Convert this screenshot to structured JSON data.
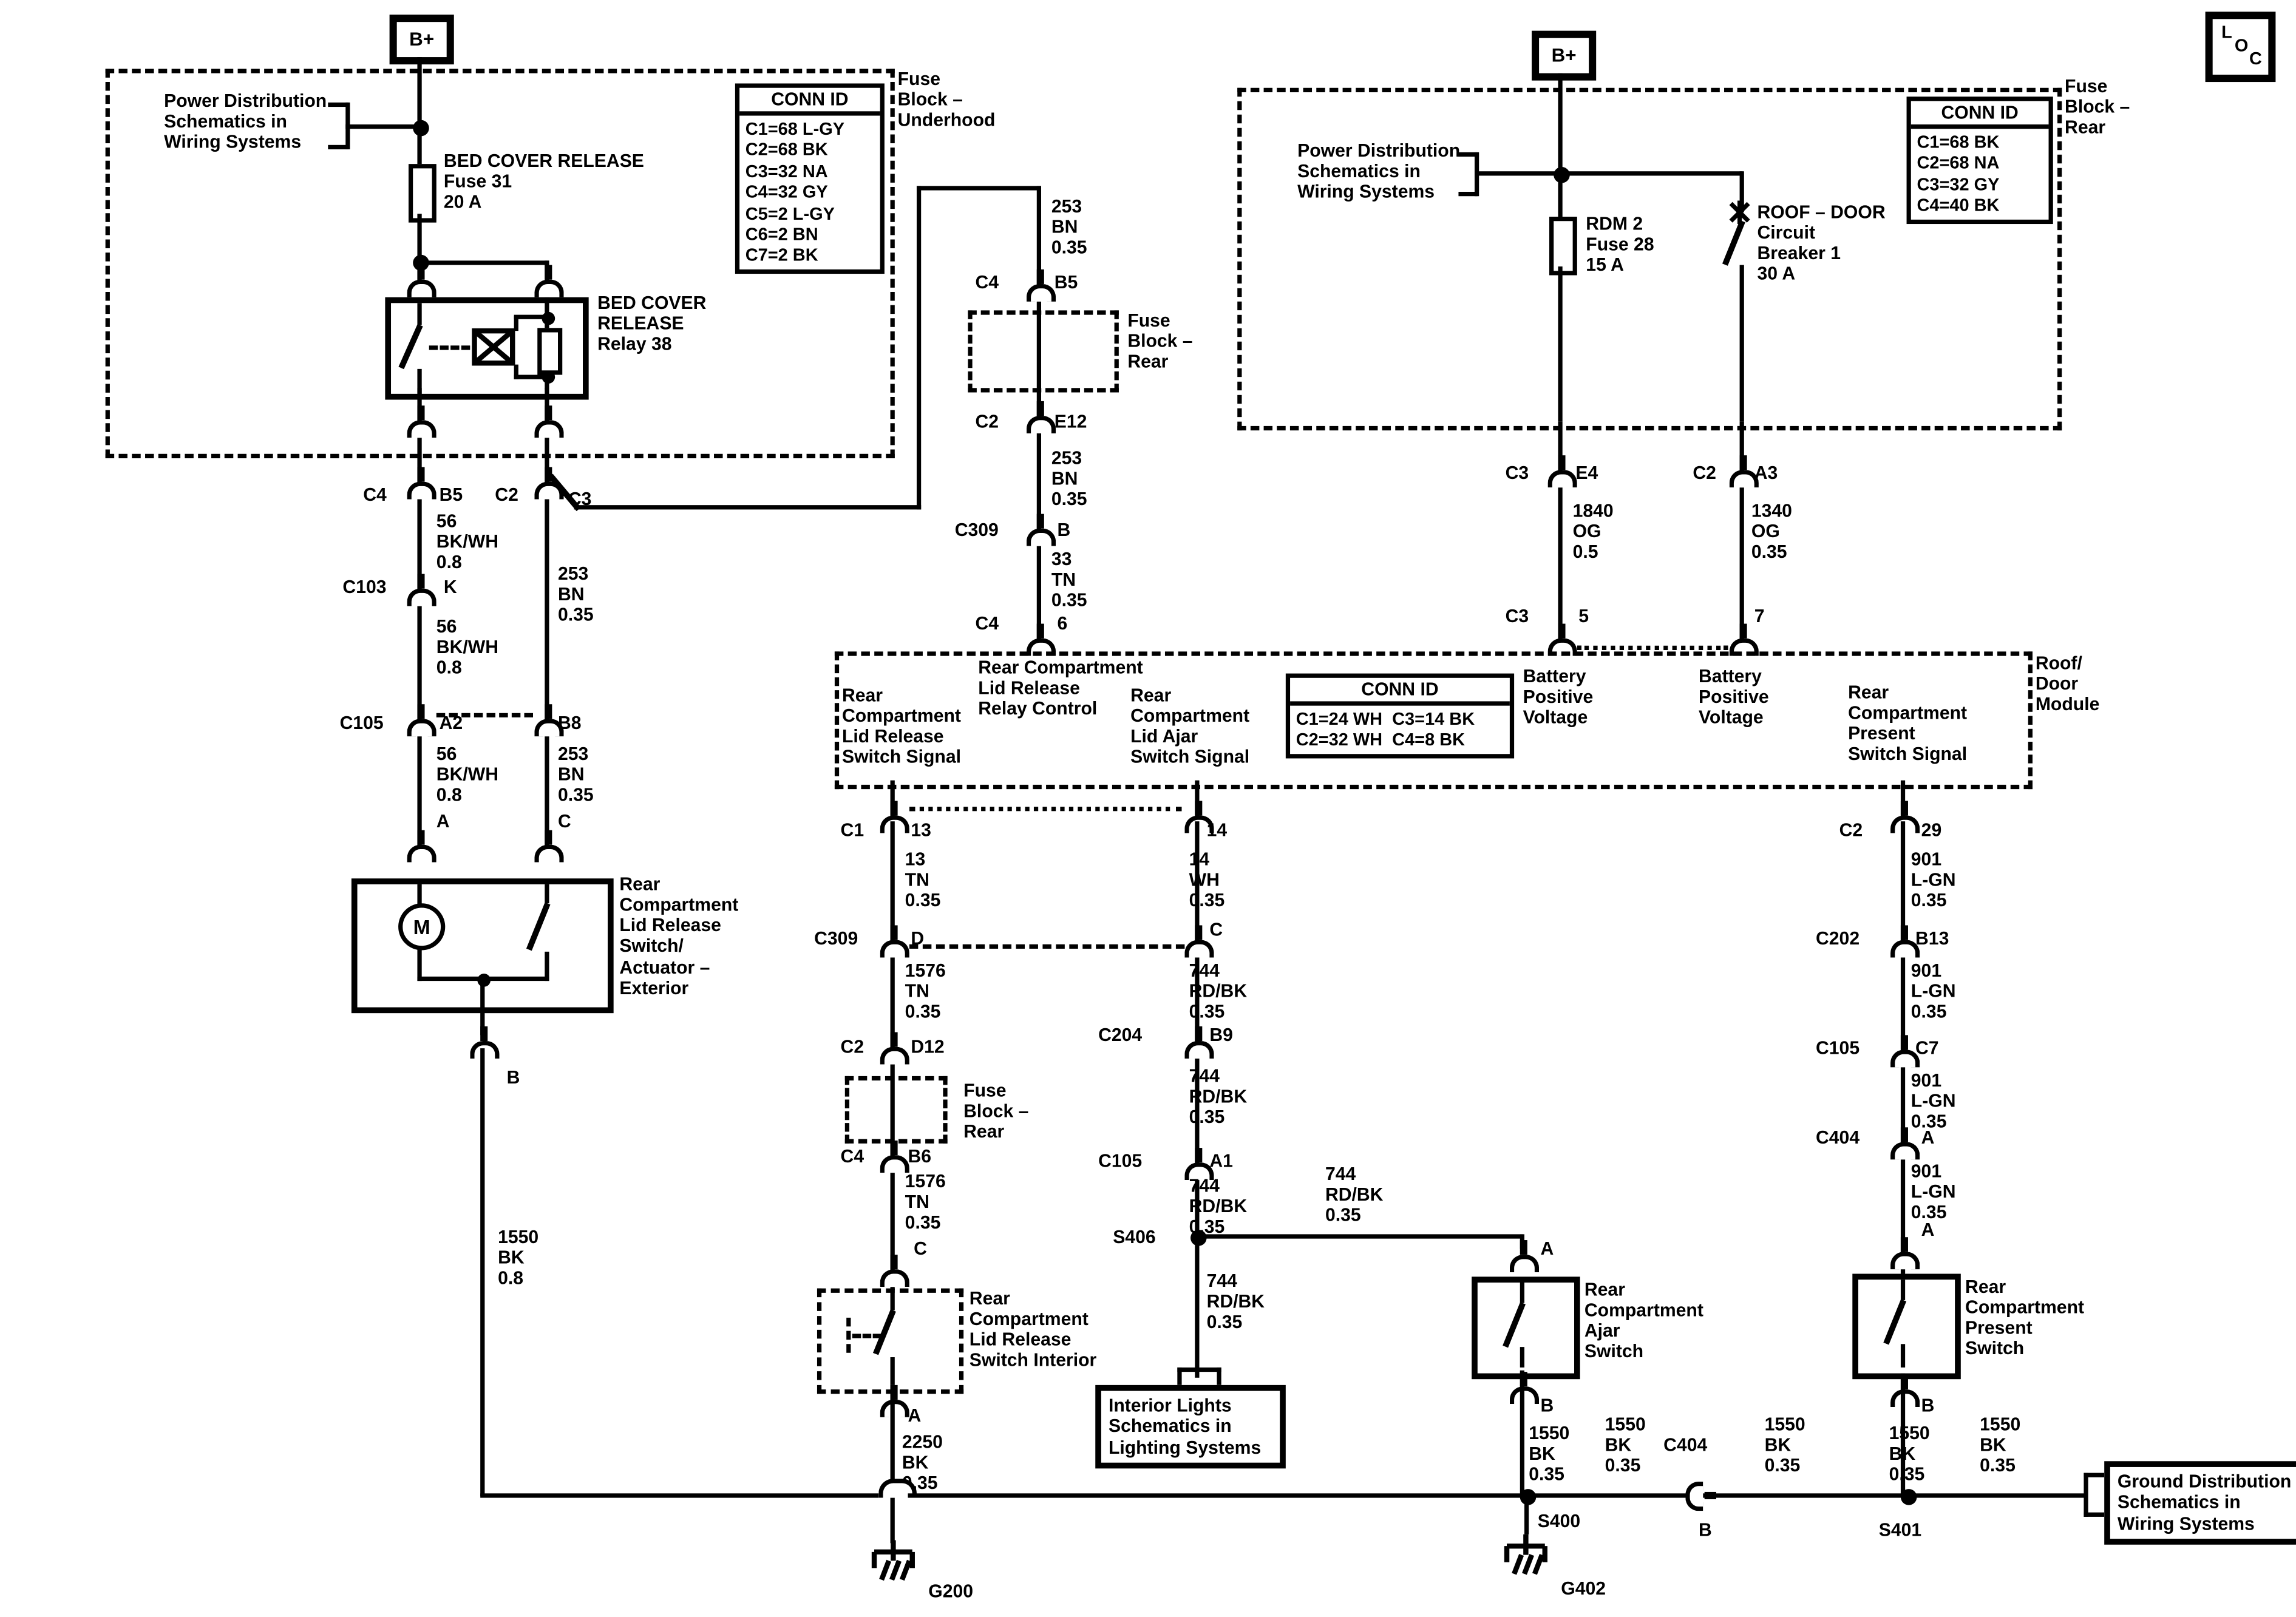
{
  "badge": {
    "l": "L",
    "o": "O",
    "c": "C"
  },
  "b_plus": "B+",
  "boxes": {
    "fuse_block_underhood": "Fuse\nBlock –\nUnderhood",
    "fuse_block_rear": "Fuse\nBlock –\nRear",
    "power_distribution": "Power Distribution\nSchematics in\nWiring Systems",
    "ground_distribution": "Ground Distribution\nSchematics in\nWiring Systems",
    "interior_lights": "Interior Lights\nSchematics in\nLighting Systems",
    "roof_door_module": "Roof/\nDoor\nModule"
  },
  "components": {
    "bed_cover_fuse": "BED COVER RELEASE\nFuse 31\n20 A",
    "bed_cover_relay": "BED COVER\nRELEASE\nRelay 38",
    "rdm2_fuse": "RDM 2\nFuse 28\n15 A",
    "roof_door_breaker": "ROOF – DOOR\nCircuit\nBreaker 1\n30 A",
    "lid_release_actuator": "Rear\nCompartment\nLid Release\nSwitch/\nActuator –\nExterior",
    "lid_release_switch_interior": "Rear\nCompartment\nLid Release\nSwitch Interior",
    "ajar_switch": "Rear\nCompartment\nAjar\nSwitch",
    "present_switch": "Rear\nCompartment\nPresent\nSwitch",
    "motor": "M"
  },
  "module_signals": {
    "relay_control": "Rear Compartment\nLid Release\nRelay Control",
    "lid_release_switch_signal": "Rear\nCompartment\nLid Release\nSwitch Signal",
    "lid_ajar_switch_signal": "Rear\nCompartment\nLid Ajar\nSwitch Signal",
    "battery_positive_1": "Battery\nPositive\nVoltage",
    "battery_positive_2": "Battery\nPositive\nVoltage",
    "present_switch_signal": "Rear\nCompartment\nPresent\nSwitch Signal"
  },
  "conn_id_underhood": {
    "title": "CONN ID",
    "rows": [
      "C1=68 L-GY",
      "C2=68 BK",
      "C3=32 NA",
      "C4=32 GY",
      "C5=2 L-GY",
      "C6=2 BN",
      "C7=2 BK"
    ]
  },
  "conn_id_rear": {
    "title": "CONN ID",
    "rows": [
      "C1=68 BK",
      "C2=68 NA",
      "C3=32 GY",
      "C4=40 BK"
    ]
  },
  "conn_id_module": {
    "title": "CONN ID",
    "rows": [
      "C1=24 WH  C3=14 BK",
      "C2=32 WH  C4=8 BK"
    ]
  },
  "wires": {
    "w56": "56\nBK/WH\n0.8",
    "w253": "253\nBN\n0.35",
    "w33": "33\nTN\n0.35",
    "w13": "13\nTN\n0.35",
    "w1576": "1576\nTN\n0.35",
    "w14": "14\nWH\n0.35",
    "w744": "744\nRD/BK\n0.35",
    "w901": "901\nL-GN\n0.35",
    "w1550": "1550\nBK\n0.35",
    "w1550_08": "1550\nBK\n0.8",
    "w2250": "2250\nBK\n0.35",
    "w1840": "1840\nOG\n0.5",
    "w1340": "1340\nOG\n0.35"
  },
  "pins": {
    "c1": "C1",
    "c2": "C2",
    "c3": "C3",
    "c4": "C4",
    "b5": "B5",
    "k": "K",
    "a2": "A2",
    "b8": "B8",
    "a": "A",
    "b": "B",
    "c": "C",
    "e12": "E12",
    "e4": "E4",
    "a3": "A3",
    "d": "D",
    "d12": "D12",
    "b6": "B6",
    "b9": "B9",
    "a1": "A1",
    "b13": "B13",
    "c7": "C7",
    "n13": "13",
    "n14": "14",
    "n29": "29",
    "n5": "5",
    "n6": "6",
    "n7": "7",
    "c103": "C103",
    "c105": "C105",
    "c202": "C202",
    "c204": "C204",
    "c309": "C309",
    "c404": "C404"
  },
  "splices": {
    "s400": "S400",
    "s401": "S401",
    "s406": "S406"
  },
  "grounds": {
    "g200": "G200",
    "g402": "G402"
  }
}
